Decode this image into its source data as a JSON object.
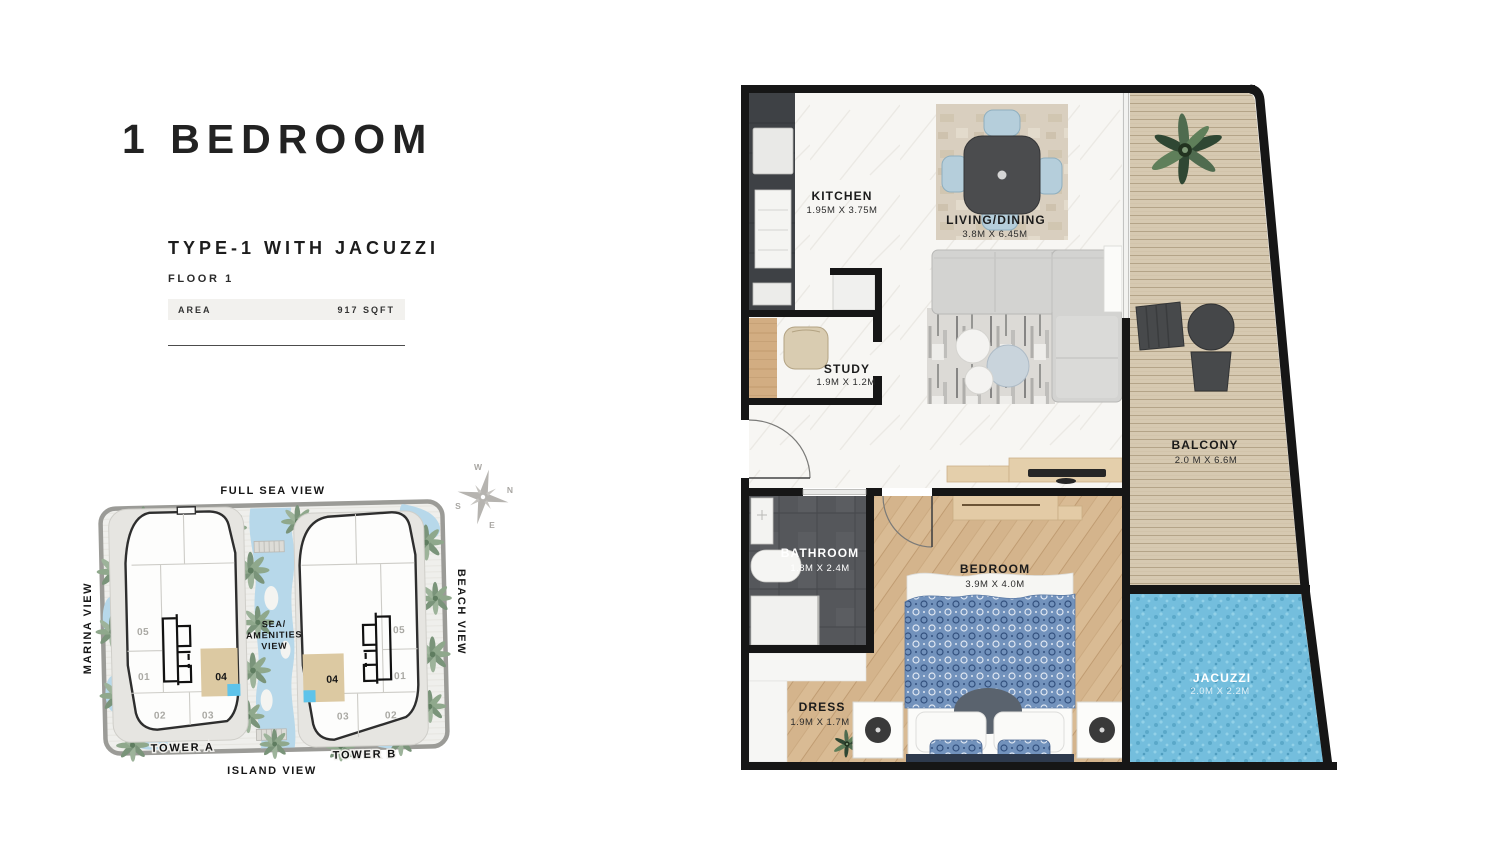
{
  "left_panel": {
    "title": "1 BEDROOM",
    "subtitle": "TYPE-1 WITH JACUZZI",
    "floor": "FLOOR 1",
    "area_label": "AREA",
    "area_value": "917 SQFT"
  },
  "site_plan": {
    "views": {
      "top": "FULL SEA VIEW",
      "bottom": "ISLAND VIEW",
      "left": "MARINA VIEW",
      "right": "BEACH VIEW",
      "center_lines": [
        "SEA/",
        "AMENITIES",
        "VIEW"
      ]
    },
    "towers": [
      {
        "label": "TOWER A",
        "highlighted_unit": "04",
        "units": {
          "u05": "05",
          "u01": "01",
          "u02": "02",
          "u03": "03",
          "u04": "04"
        }
      },
      {
        "label": "TOWER B",
        "highlighted_unit": "04",
        "units": {
          "u05": "05",
          "u01": "01",
          "u02": "02",
          "u03": "03",
          "u04": "04"
        }
      }
    ],
    "compass": {
      "n": "N",
      "s": "S",
      "e": "E",
      "w": "W"
    }
  },
  "floor_plan": {
    "rooms": {
      "kitchen": {
        "name": "KITCHEN",
        "dims": "1.95M X 3.75M"
      },
      "living": {
        "name": "LIVING/DINING",
        "dims": "3.8M X 6.45M"
      },
      "study": {
        "name": "STUDY",
        "dims": "1.9M X 1.2M"
      },
      "balcony": {
        "name": "BALCONY",
        "dims": "2.0 M X 6.6M"
      },
      "bathroom": {
        "name": "BATHROOM",
        "dims": "1.8M X 2.4M"
      },
      "bedroom": {
        "name": "BEDROOM",
        "dims": "3.9M X 4.0M"
      },
      "dress": {
        "name": "DRESS",
        "dims": "1.9M X 1.7M"
      },
      "jacuzzi": {
        "name": "JACUZZI",
        "dims": "2.0M X 2.2M"
      }
    }
  },
  "colors": {
    "wall": "#161616",
    "marble_floor": "#f7f6f3",
    "bedroom_wood": "#d9bb94",
    "balcony_deck": "#d6c9b1",
    "jacuzzi_water": "#74bedd",
    "bathroom_tile": "#55575b",
    "highlight_unit_beige": "#dcc9a2",
    "unit_marker_blue": "#5ec3ea",
    "pool_blue": "#b7d8ea",
    "dining_chair_blue": "#b5cedb",
    "site_border_gray": "#9b9b97"
  }
}
